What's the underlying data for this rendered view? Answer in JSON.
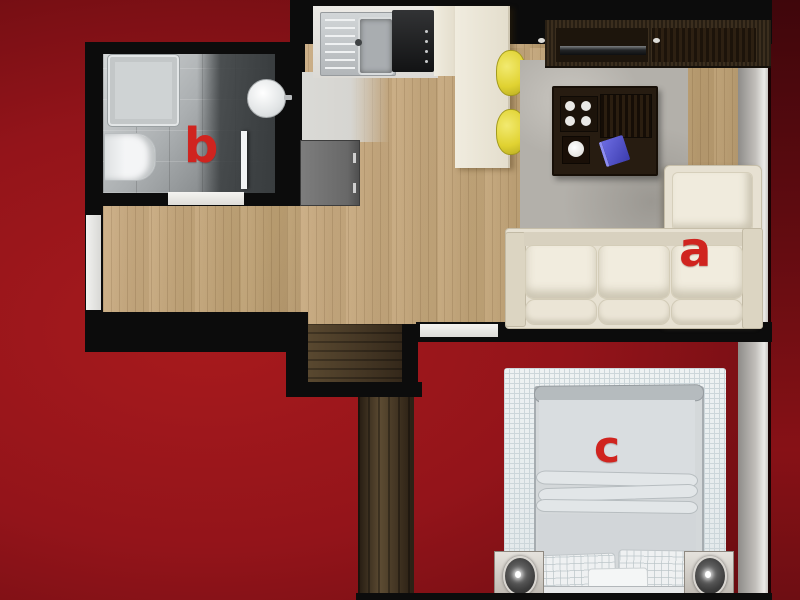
{
  "labels": {
    "a": "a",
    "b": "b",
    "c": "c"
  },
  "rooms": [
    {
      "label": "a",
      "object": "sofa-living-room"
    },
    {
      "label": "b",
      "object": "bathroom-floor"
    },
    {
      "label": "c",
      "object": "bed-bedroom"
    }
  ],
  "objects": [
    "bathroom-toilet",
    "bathroom-round-sink",
    "shower-mat",
    "glass-door",
    "kitchen-sink",
    "stove",
    "kitchen-counter",
    "bar-stools",
    "gray-cabinet",
    "tv-console",
    "coffee-table",
    "rug",
    "sectional-sofa",
    "bed",
    "bed-rug",
    "nightstand-left",
    "nightstand-right",
    "wardrobe"
  ],
  "colors": {
    "background_red": "#93141a",
    "label_red": "#d0241f",
    "wall_black": "#0c0c0c",
    "wood_floor": "#c5a87e",
    "stool_yellow": "#e3d53a",
    "sofa_cream": "#e9e3d4"
  }
}
